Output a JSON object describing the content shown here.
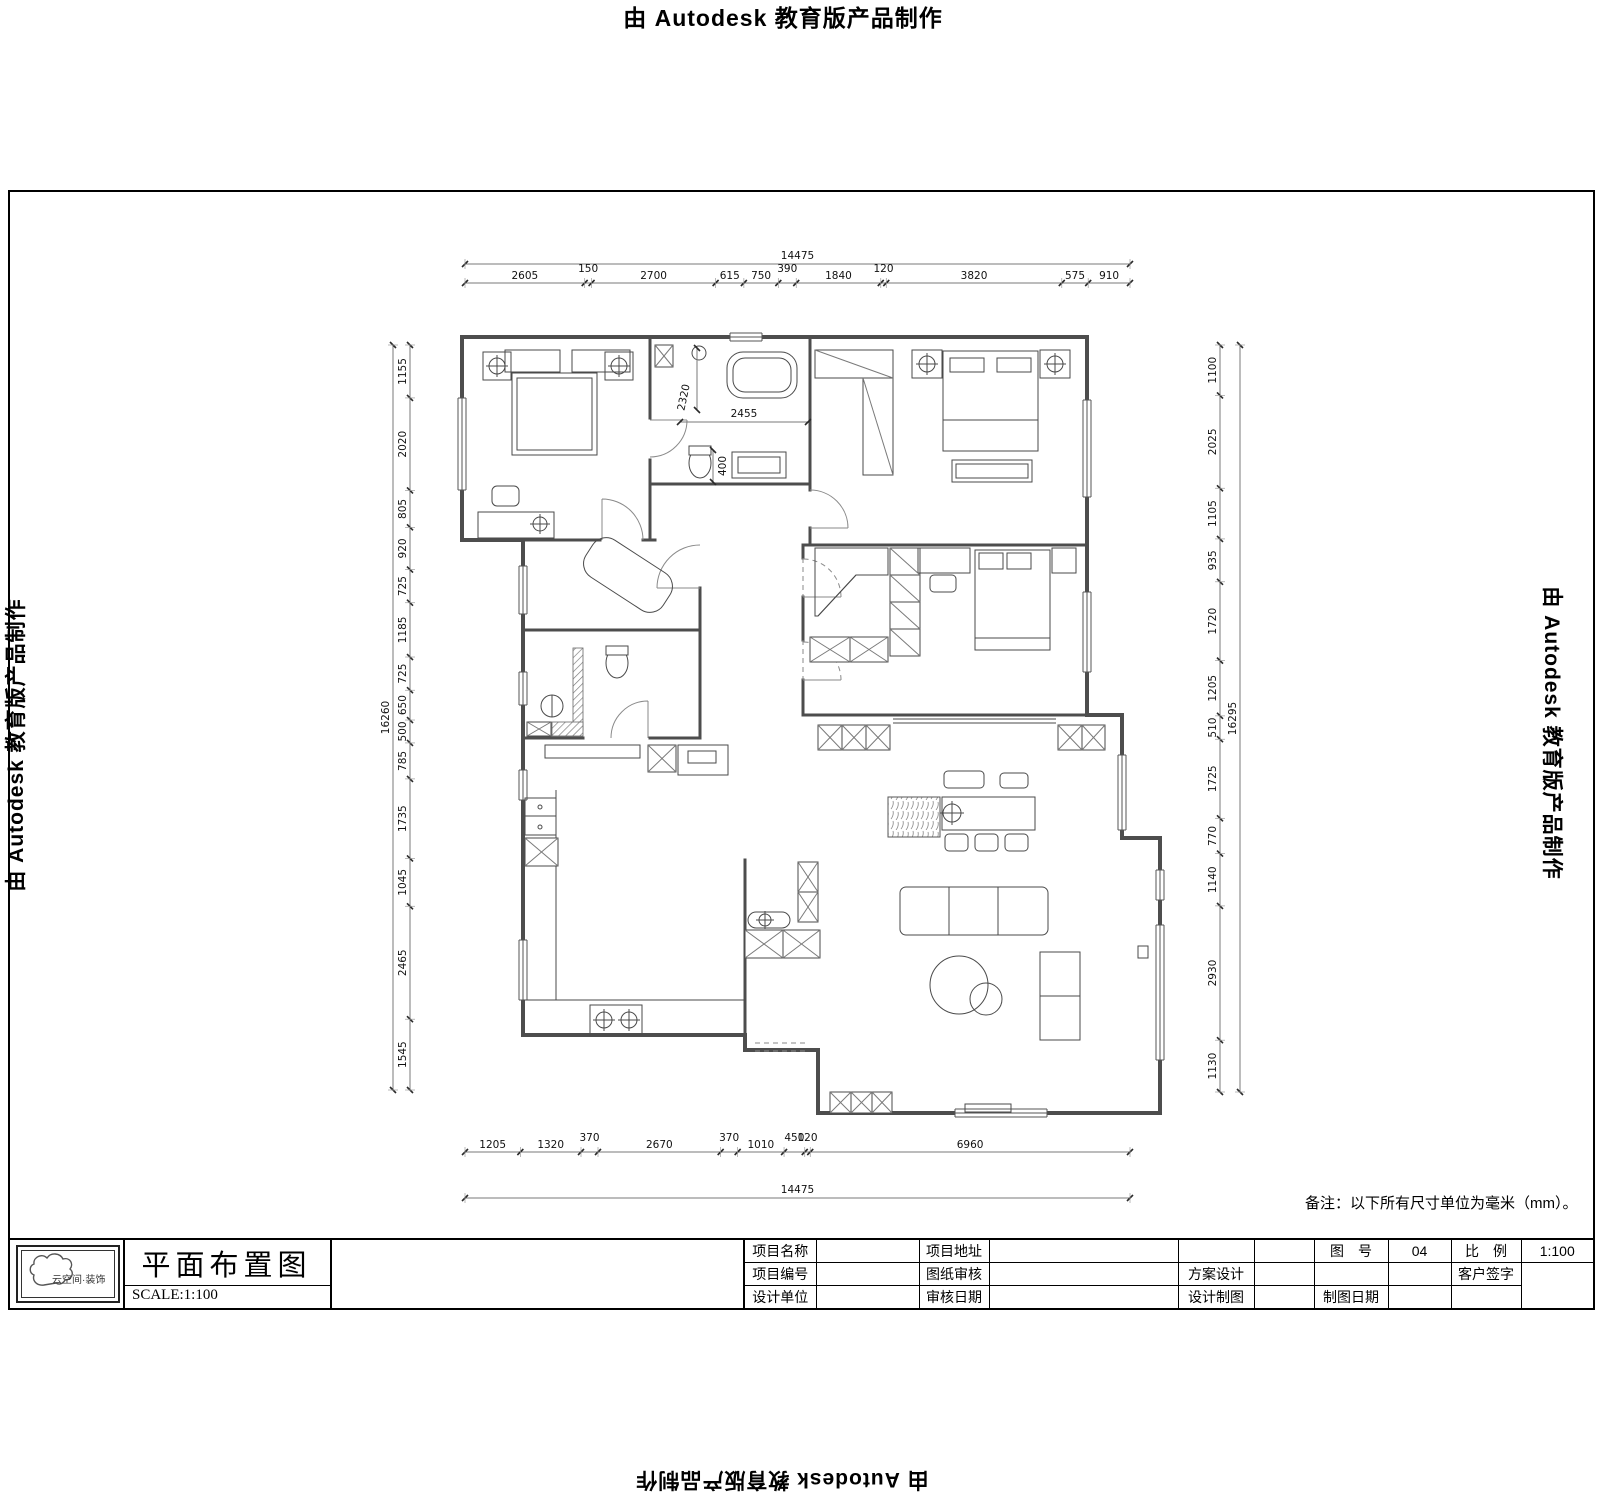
{
  "watermark": {
    "text": "由 Autodesk 教育版产品制作"
  },
  "note": "备注：以下所有尺寸单位为毫米（mm）。",
  "title_block": {
    "logo_text": "云空间·装饰",
    "drawing_title": "平面布置图",
    "scale_label": "SCALE:1:100",
    "table": {
      "r1c1": "项目名称",
      "r1c3": "项目地址",
      "r1c7": "图　号",
      "r1c8": "04",
      "r1c9": "比　例",
      "r1c10": "1:100",
      "r2c1": "项目编号",
      "r2c3": "图纸审核",
      "r2c5": "方案设计",
      "r2c9": "客户签字",
      "r3c1": "设计单位",
      "r3c3": "审核日期",
      "r3c5": "设计制图",
      "r3c7": "制图日期"
    }
  },
  "dimensions": {
    "top": {
      "total": "14475",
      "segments": [
        2605,
        150,
        2700,
        615,
        750,
        390,
        1840,
        120,
        3820,
        575,
        910
      ]
    },
    "bottom": {
      "total": "14475",
      "segments": [
        1205,
        1320,
        370,
        2670,
        370,
        1010,
        450,
        120,
        6960
      ]
    },
    "left": {
      "total": "16260",
      "segments": [
        1155,
        2020,
        805,
        920,
        725,
        1185,
        725,
        650,
        500,
        785,
        1735,
        1045,
        2465,
        1545
      ]
    },
    "right": {
      "total": "16295",
      "segments": [
        1100,
        2025,
        1105,
        935,
        1720,
        1205,
        510,
        1725,
        770,
        1140,
        2930,
        1130
      ]
    },
    "inner": [
      "2320",
      "2455",
      "400"
    ]
  }
}
